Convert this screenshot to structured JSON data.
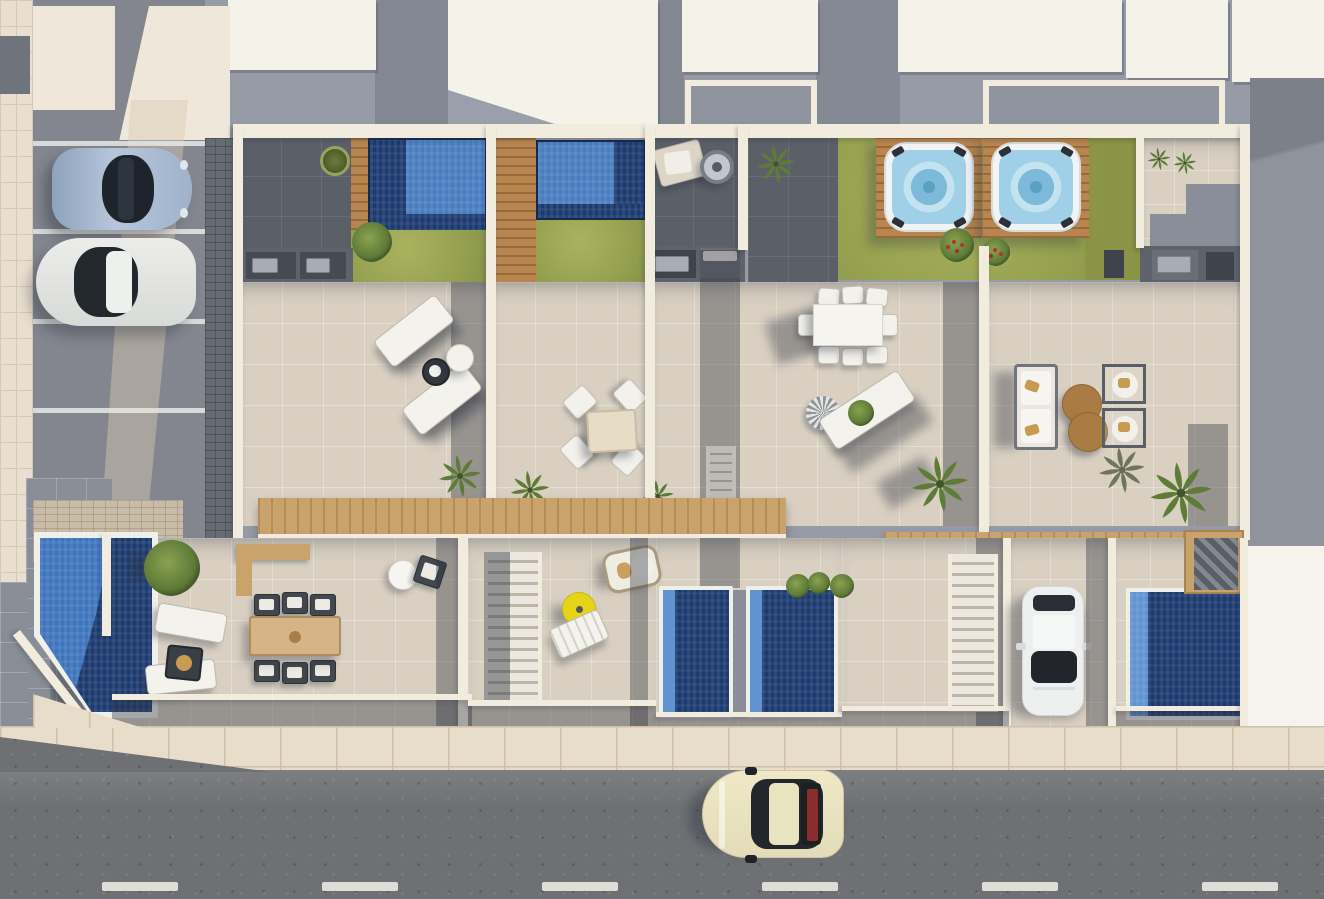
{
  "scene": {
    "type": "architectural-aerial-render",
    "description": "Top-down 3D render of four modern townhouses with rooftop lap pools and hot tubs, tiled roof terraces, ground-floor patios with plunge pools, a communal pool garden, a parking bay with two cars and a street with a driving classic car",
    "view": "top-down",
    "units_count": 4,
    "visible_text": ""
  },
  "palette": {
    "groundGray": "#969ba6",
    "roofWhite": "#f5f2ea",
    "wallCream": "#f2ecdf",
    "tileBeige": "#d9d0c2",
    "tileGray": "#898d95",
    "pavingDark": "#5b5f68",
    "cobble": "#676b73",
    "lawn": "#9fa855",
    "lawnDark": "#8b9446",
    "poolLight": "#4a7cc0",
    "poolNavy": "#1c3a6f",
    "plungeLight": "#5f93d2",
    "hotTubWater": "#9fd0e8",
    "woodDeck": "#b9854e",
    "woodPlank": "#c9a36b",
    "sidewalk": "#e8ddcb",
    "road": "#6e7074",
    "steel": "#a7adb4",
    "umbrellaYellow": "#e6d517",
    "poufBrown": "#a87c42",
    "carCream": "#ece5c3",
    "carSilver": "#a8bad2",
    "carWhite": "#eef0f0",
    "furnitureWhite": "#f3f2ed",
    "darkBox": "#43474e"
  },
  "inventory": {
    "townhouses": [
      {
        "unit": 1,
        "rooftop": [
          "lap pool with wood deck",
          "lawn with shrub",
          "bbq counter",
          "round planter pot"
        ],
        "terrace": [
          "2 sun loungers",
          "round side table",
          "white pouf",
          "palm"
        ]
      },
      {
        "unit": 2,
        "rooftop": [
          "lap pool",
          "wide wood deck",
          "lawn"
        ],
        "terrace": [
          "square table",
          "4 white chairs",
          "2 palms"
        ]
      },
      {
        "unit": 3,
        "rooftop": [
          "lounge chair",
          "round table",
          "palm",
          "bbq counter",
          "hot tub on wood deck",
          "shared lawn"
        ],
        "terrace": [
          "white dining table",
          "6 chairs",
          "angled daybed with fan end",
          "large palm"
        ]
      },
      {
        "unit": 4,
        "rooftop": [
          "hot tub on wood deck",
          "shared lawn",
          "flowering shrubs",
          "bbq counter",
          "2 small palms",
          "stepped gray paving"
        ],
        "terrace": [
          "outdoor sofa",
          "2 round brown poufs",
          "2 framed lounge chairs",
          "palms"
        ]
      }
    ],
    "ground_level": [
      {
        "area": "pool-garden",
        "items": [
          "large pentagon pool",
          "tree",
          "2 loungers",
          "fire table",
          "wooden dining table with 6 dark chairs",
          "corner wood planter",
          "white bistro table with chair"
        ]
      },
      {
        "area": "patio-2",
        "items": [
          "staircase",
          "hanging egg chair",
          "yellow parasol table",
          "white deck chair"
        ]
      },
      {
        "area": "plunge-pool-court",
        "items": [
          "2 navy plunge pools",
          "vine planter"
        ]
      },
      {
        "area": "patio-3",
        "items": [
          "staircase",
          "white car on tiled driveway"
        ]
      },
      {
        "area": "patio-4",
        "items": [
          "navy plunge pool",
          "corner wood stair"
        ]
      }
    ],
    "parking": {
      "stalls": 4,
      "occupied": 2,
      "cars": [
        {
          "type": "sports car",
          "color": "silver blue"
        },
        {
          "type": "sedan",
          "color": "white"
        }
      ]
    },
    "street": {
      "surface": "asphalt",
      "lane_dashes": 6,
      "car": {
        "type": "classic coupe",
        "color": "cream",
        "detail": "dark canopy with red rear panel"
      }
    }
  }
}
